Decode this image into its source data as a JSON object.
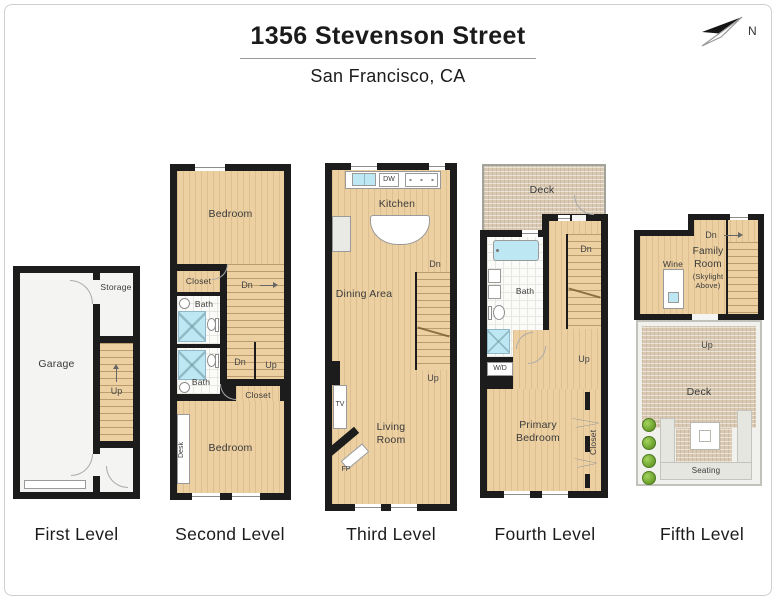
{
  "header": {
    "title": "1356 Stevenson Street",
    "subtitle": "San Francisco, CA",
    "compass": "N"
  },
  "levels": {
    "first": {
      "label": "First Level",
      "garage": "Garage",
      "storage": "Storage",
      "up": "Up"
    },
    "second": {
      "label": "Second Level",
      "bedroom_top": "Bedroom",
      "closet_left": "Closet",
      "bath_upper": "Bath",
      "bath_lower": "Bath",
      "dn_upper": "Dn",
      "dn": "Dn",
      "up": "Up",
      "closet_right": "Closet",
      "desk": "Desk",
      "bedroom_bottom": "Bedroom"
    },
    "third": {
      "label": "Third Level",
      "kitchen": "Kitchen",
      "dw": "DW",
      "dining_area": "Dining Area",
      "dn": "Dn",
      "up": "Up",
      "tv": "TV",
      "fp": "FP",
      "living_room": "Living Room"
    },
    "fourth": {
      "label": "Fourth Level",
      "deck": "Deck",
      "bath": "Bath",
      "wd": "W/D",
      "dn": "Dn",
      "up": "Up",
      "primary_bedroom": "Primary Bedroom",
      "closet": "Closet"
    },
    "fifth": {
      "label": "Fifth Level",
      "wine": "Wine",
      "family_room": "Family Room",
      "skylight_note": "(Skylight Above)",
      "dn": "Dn",
      "up": "Up",
      "deck": "Deck",
      "seating": "Seating"
    }
  },
  "colors": {
    "wall": "#1c1c1c",
    "wood_floor": "#ecd0a2",
    "tile_floor": "#fbfbf9",
    "water_fixture": "#bde8f3",
    "deck_surface": "#d9c9b2",
    "seating": "#e6e6e1",
    "plant_green": "#6da32e"
  }
}
